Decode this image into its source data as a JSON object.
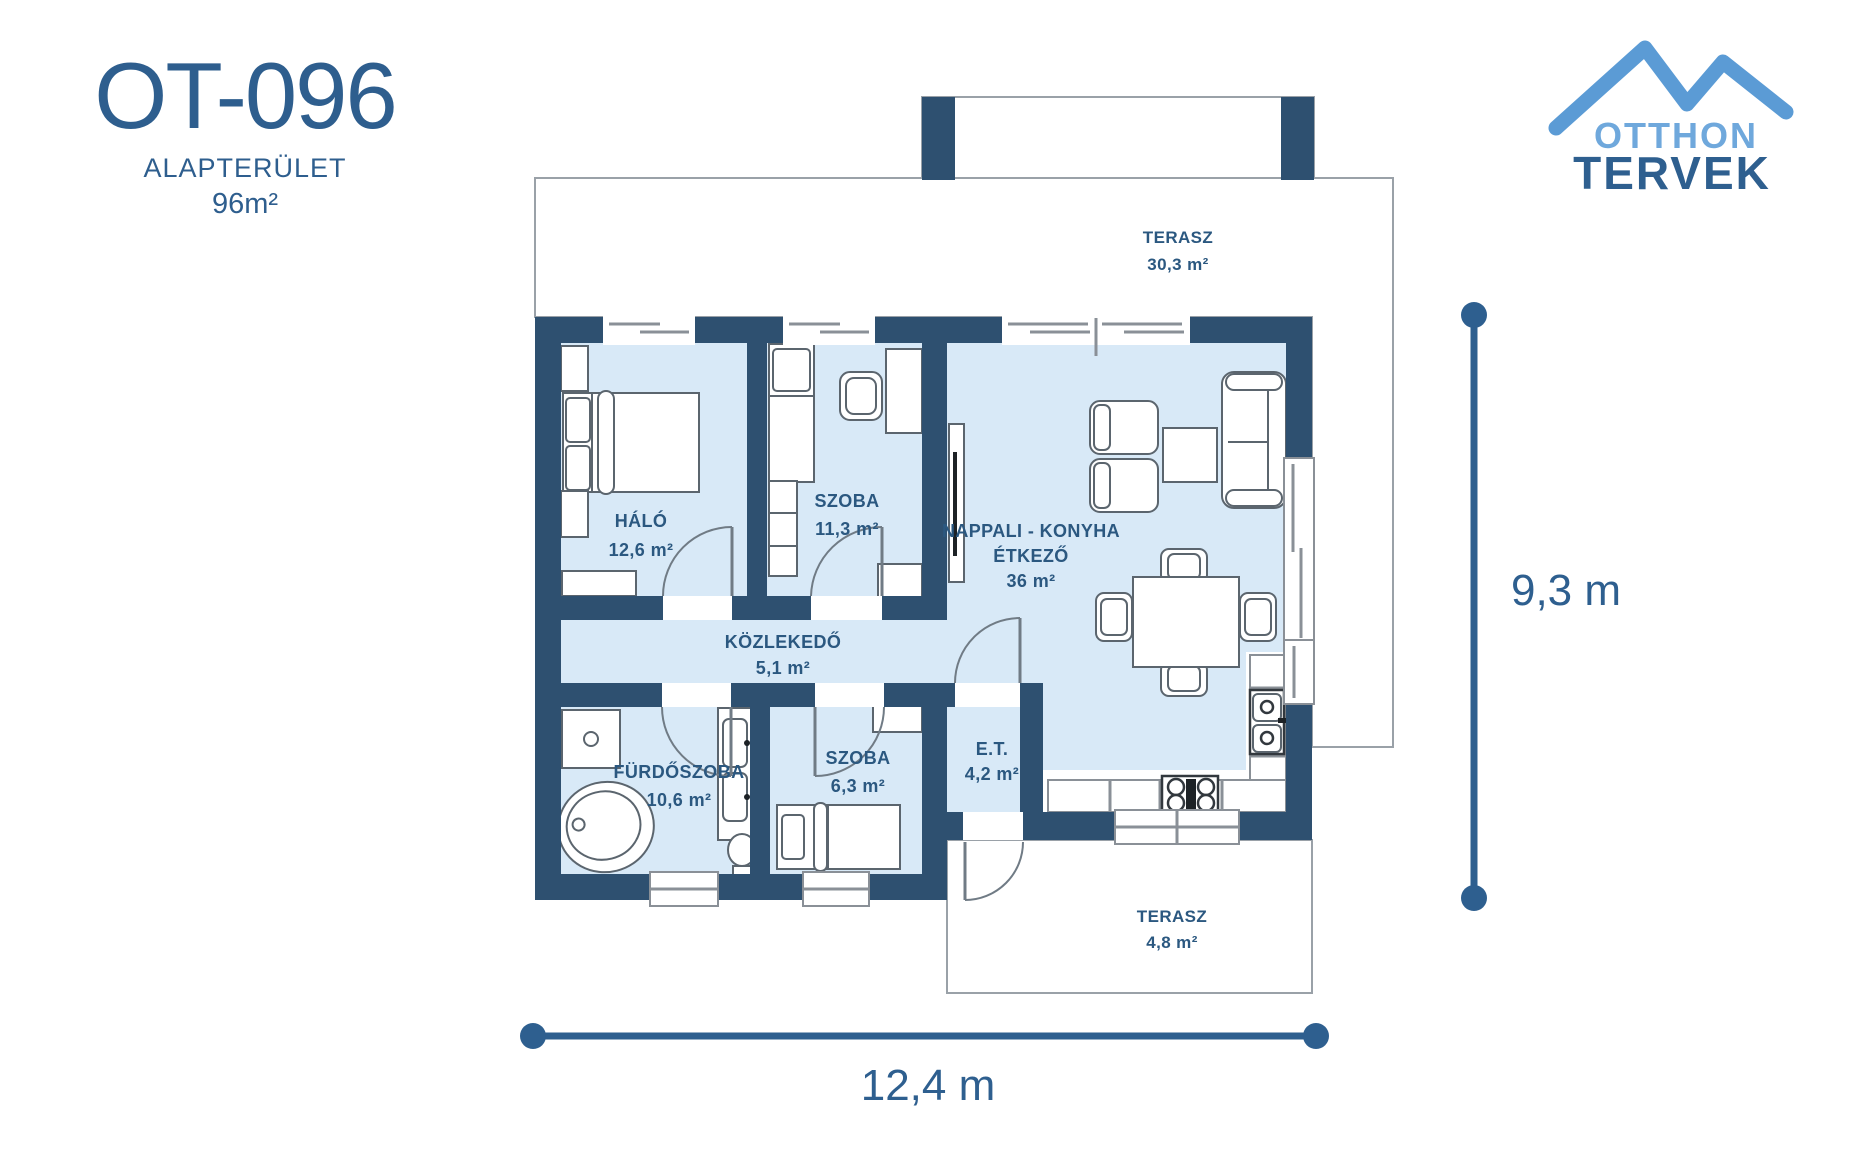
{
  "header": {
    "plan_code": "OT-096",
    "area_label": "ALAPTERÜLET",
    "area_value": "96m²"
  },
  "logo": {
    "word1": "OTTHON",
    "word2": "TERVEK"
  },
  "dimensions": {
    "width": "12,4 m",
    "height": "9,3 m"
  },
  "rooms": {
    "terasz_top": {
      "name": "TERASZ",
      "area": "30,3 m²"
    },
    "halo": {
      "name": "HÁLÓ",
      "area": "12,6 m²"
    },
    "szoba_top": {
      "name": "SZOBA",
      "area": "11,3 m²"
    },
    "nappali": {
      "line1": "NAPPALI - KONYHA",
      "line2": "ÉTKEZŐ",
      "area": "36 m²"
    },
    "kozlekedo": {
      "name": "KÖZLEKEDŐ",
      "area": "5,1 m²"
    },
    "furdoszoba": {
      "name": "FÜRDŐSZOBA",
      "area": "10,6 m²"
    },
    "szoba_bottom": {
      "name": "SZOBA",
      "area": "6,3 m²"
    },
    "et": {
      "name": "E.T.",
      "area": "4,2 m²"
    },
    "terasz_bottom": {
      "name": "TERASZ",
      "area": "4,8 m²"
    }
  },
  "colors": {
    "wall": "#2E5070",
    "floor": "#D8E9F7",
    "accent_dark": "#2E5F8F",
    "accent_light": "#6FA8DC",
    "outline_gray": "#9AA1A8",
    "title_blue": "#2E5E8E"
  }
}
